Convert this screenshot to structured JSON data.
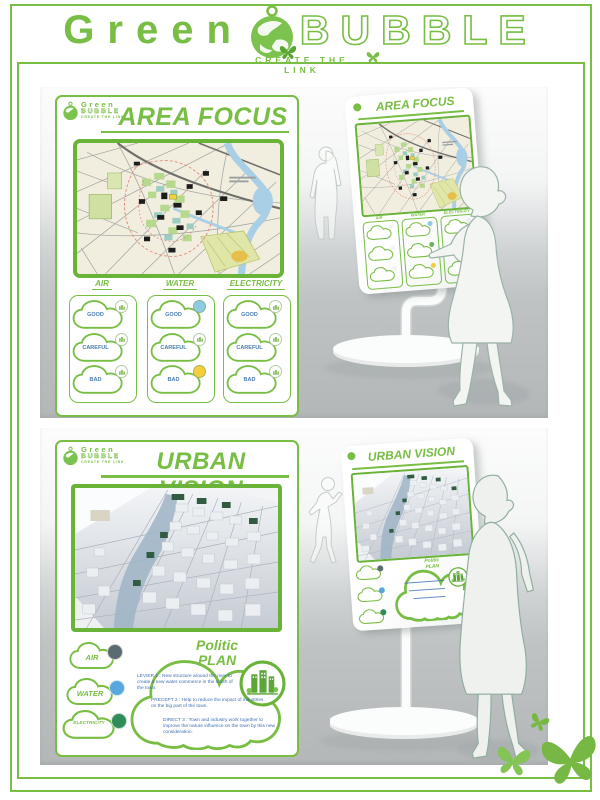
{
  "brand": {
    "word1": "Green",
    "word2": "BUBBLE",
    "tagline": "CREATE THE LINK"
  },
  "colors": {
    "green": "#78bd44",
    "cloud_label": "#4a7db0"
  },
  "area_focus": {
    "title": "AREA FOCUS",
    "columns": [
      {
        "label": "AIR",
        "rows": [
          {
            "label": "GOOD",
            "badge_color": "#ffffff"
          },
          {
            "label": "CAREFUL",
            "badge_color": "#ffffff"
          },
          {
            "label": "BAD",
            "badge_color": "#ffffff"
          }
        ]
      },
      {
        "label": "WATER",
        "rows": [
          {
            "label": "GOOD",
            "badge_color": "#8ecbe3"
          },
          {
            "label": "CAREFUL",
            "badge_color": "#ffffff"
          },
          {
            "label": "BAD",
            "badge_color": "#f3cf3e"
          }
        ]
      },
      {
        "label": "ELECTRICITY",
        "rows": [
          {
            "label": "GOOD",
            "badge_color": "#ffffff"
          },
          {
            "label": "CAREFUL",
            "badge_color": "#ffffff"
          },
          {
            "label": "BAD",
            "badge_color": "#ffffff"
          }
        ]
      }
    ]
  },
  "urban_vision": {
    "title": "URBAN VISION",
    "clouds": [
      {
        "label": "AIR",
        "dot": "#5c6b70"
      },
      {
        "label": "WATER",
        "dot": "#57a8dc"
      },
      {
        "label": "ELECTRICITY",
        "dot": "#2f8b57"
      }
    ],
    "plan": {
      "title_top": "Politic",
      "title_bottom": "PLAN",
      "items": [
        {
          "text": "LEVIER 1 : New structure around the river to create a new water commerce in the south of the town."
        },
        {
          "text": "PRECEPT 2 : Help to reduce the impact of industries on the big part of the town."
        },
        {
          "text": "DIRECT 3 : Town and industry work together to improve the nature influence on the town by this new consideration."
        }
      ]
    }
  },
  "kiosk1": {
    "dots": [
      [
        "#f4f4f4",
        "#f4f4f4",
        "#f4f4f4"
      ],
      [
        "#8ecbe3",
        "#6cb35e",
        "#f3cf3e"
      ],
      [
        "#ededed",
        "#cfd6a8",
        "#6b6b3a"
      ]
    ]
  }
}
